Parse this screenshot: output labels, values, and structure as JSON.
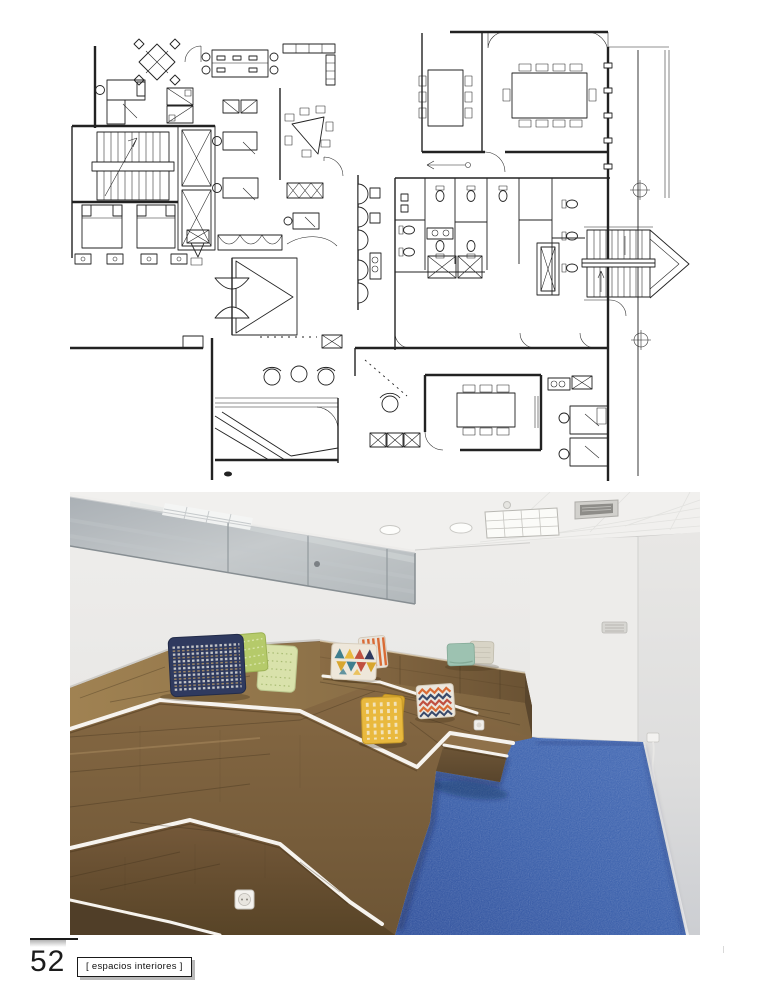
{
  "page": {
    "number": "52",
    "section_label": "[ espacios interiores ]"
  },
  "figures": {
    "floor_plan": "office-floor-plan",
    "photo": "tiered-wood-seating-room"
  },
  "colors": {
    "page_bg": "#ffffff",
    "plan_line": "#222222",
    "carpet_blue": "#3e63ad",
    "wood_light": "#9a7b50",
    "wood_mid": "#7c6140",
    "wood_dark": "#55422b",
    "edge_strip": "#f6f3ee",
    "ceiling": "#f0efed",
    "mirror_glass": "#b7bcc0",
    "wall": "#eae9e7",
    "pillow_navy": "#2f3a5f",
    "pillow_lime": "#b5ca6a",
    "pillow_pale_green": "#d9e2ab",
    "pillow_teal": "#9dc2b1",
    "pillow_beige": "#d8d4c6",
    "pillow_yellow": "#e9b93e",
    "pillow_mustard": "#d8a62e",
    "pillow_orange": "#d96b35",
    "pillow_red": "#c05040",
    "footer_shadow": "#b9b9b9"
  }
}
